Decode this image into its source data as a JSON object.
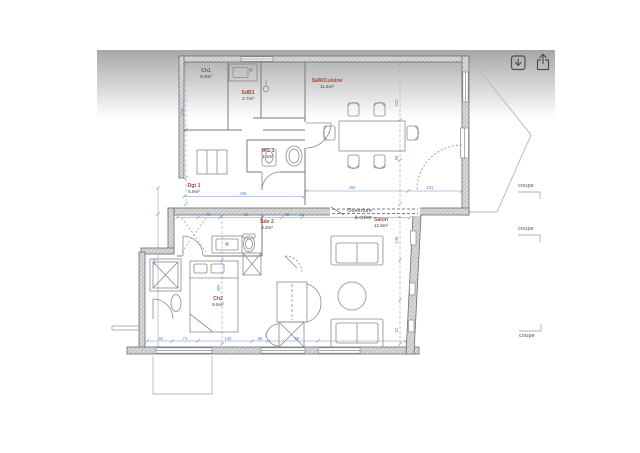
{
  "toolbar": {
    "buttons": [
      {
        "name": "download",
        "icon": "download-icon"
      },
      {
        "name": "share",
        "icon": "share-icon"
      }
    ]
  },
  "plan": {
    "rooms": [
      {
        "name": "Ch1",
        "area": "9.4m²",
        "x": 206,
        "y": 72
      },
      {
        "name": "SdB1",
        "area": "2.7m²",
        "x": 248,
        "y": 94
      },
      {
        "name": "SàM/Cuisine",
        "area": "11.5m²",
        "x": 327,
        "y": 82
      },
      {
        "name": "WC 1",
        "area": "1.5m²",
        "x": 268,
        "y": 152
      },
      {
        "name": "Dgt 1",
        "area": "5.9m²",
        "x": 194,
        "y": 187
      },
      {
        "name": "Sde 2",
        "area": "3.3m²",
        "x": 267,
        "y": 223
      },
      {
        "name": "Salon",
        "area": "12.9m²",
        "x": 381,
        "y": 221
      },
      {
        "name": "Ch2",
        "area": "9.5m²",
        "x": 218,
        "y": 300
      }
    ],
    "note": {
      "lines": [
        "Ouverture",
        "à créer"
      ],
      "x": 372,
      "y": 212,
      "line_height": 7
    },
    "section_markers": [
      {
        "label": "coupe",
        "x": 526,
        "y": 187,
        "hook": "down"
      },
      {
        "label": "coupe",
        "x": 526,
        "y": 230,
        "hook": "down"
      },
      {
        "label": "coupe",
        "x": 527,
        "y": 337,
        "hook": "up"
      }
    ],
    "dimensions": [
      {
        "text": "348",
        "x": 243,
        "y": 195,
        "rot": 0
      },
      {
        "text": "265",
        "x": 352,
        "y": 189,
        "rot": 0
      },
      {
        "text": "151",
        "x": 430,
        "y": 189,
        "rot": 0
      },
      {
        "text": "73",
        "x": 208,
        "y": 216,
        "rot": 0
      },
      {
        "text": "63",
        "x": 246,
        "y": 216,
        "rot": 0
      },
      {
        "text": "35",
        "x": 287,
        "y": 216,
        "rot": 0
      },
      {
        "text": "15",
        "x": 302,
        "y": 216,
        "rot": 0
      },
      {
        "text": "50",
        "x": 161,
        "y": 340,
        "rot": 0
      },
      {
        "text": "71",
        "x": 185,
        "y": 340,
        "rot": 0
      },
      {
        "text": "140",
        "x": 228,
        "y": 340,
        "rot": 0
      },
      {
        "text": "88",
        "x": 260,
        "y": 340,
        "rot": 0
      },
      {
        "text": "60",
        "x": 297,
        "y": 340,
        "rot": 0
      },
      {
        "text": "229",
        "x": 184,
        "y": 112,
        "rot": -90
      },
      {
        "text": "378",
        "x": 156,
        "y": 262,
        "rot": -90
      },
      {
        "text": "300",
        "x": 220,
        "y": 288,
        "rot": -90
      },
      {
        "text": "220",
        "x": 398,
        "y": 103,
        "rot": -90
      },
      {
        "text": "88",
        "x": 398,
        "y": 158,
        "rot": -90
      },
      {
        "text": "136",
        "x": 398,
        "y": 240,
        "rot": -90
      },
      {
        "text": "52",
        "x": 398,
        "y": 330,
        "rot": -90
      }
    ],
    "colors": {
      "room_name": "#a14b3c",
      "room_area": "#3d3d3d",
      "dimension": "#5b85c0",
      "dim_line": "#9ab7dc",
      "wall": "#6e6e6e",
      "note": "#3a3a3a",
      "marker": "#4f4f4f",
      "icon": "#4f4f4f"
    }
  }
}
